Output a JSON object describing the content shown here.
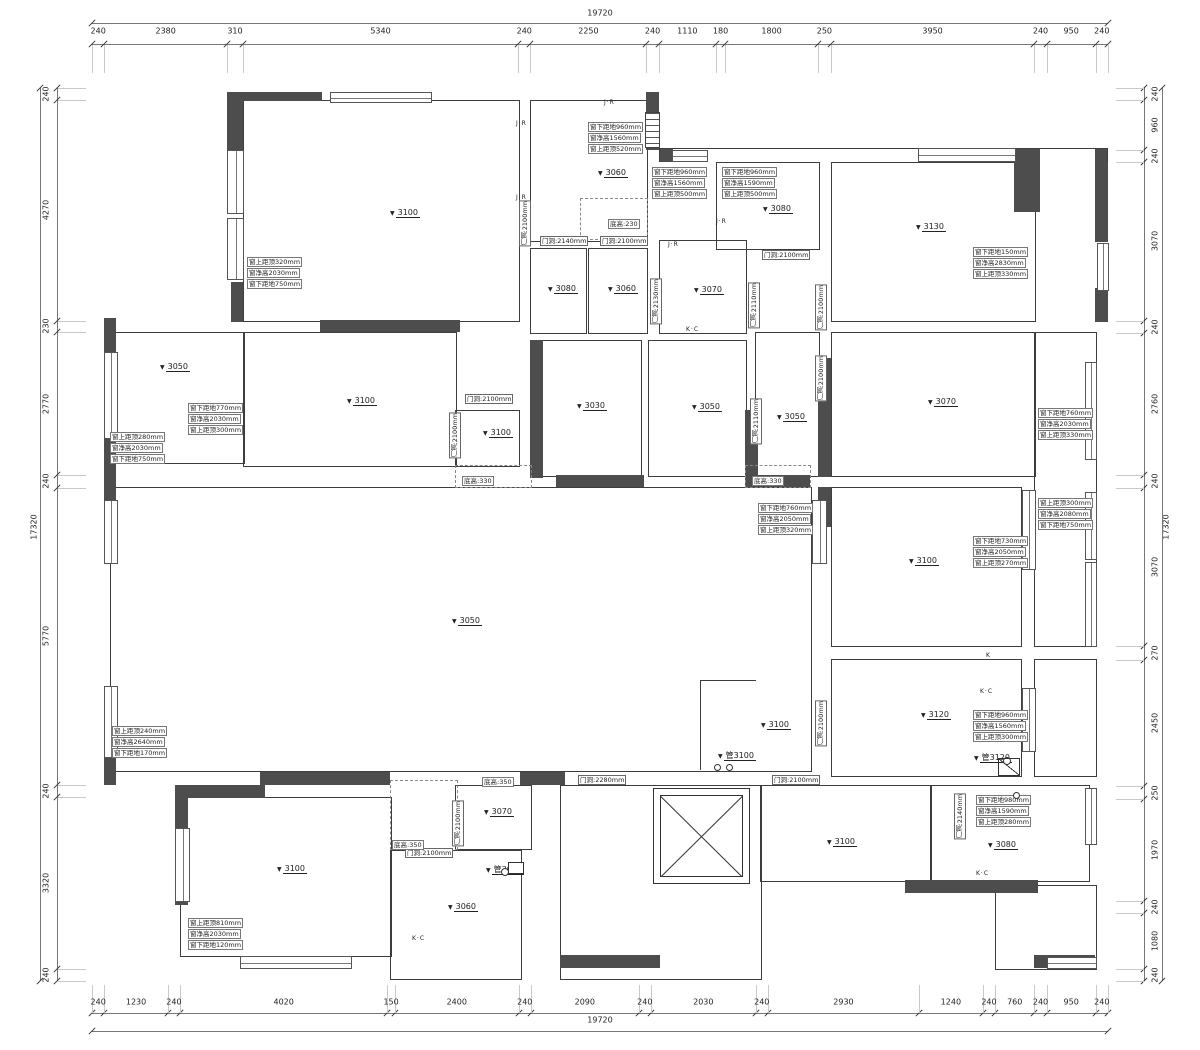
{
  "drawing_title": "floor-plan",
  "dims": {
    "top": {
      "total": "19720",
      "segments": [
        "240",
        "2380",
        "310",
        "5340",
        "240",
        "2250",
        "240",
        "1110",
        "180",
        "1800",
        "250",
        "3950",
        "240",
        "950",
        "240"
      ]
    },
    "bottom": {
      "total": "19720",
      "segments": [
        "240",
        "1230",
        "240",
        "4020",
        "150",
        "2400",
        "240",
        "2090",
        "240",
        "2030",
        "240",
        "2930",
        "1240",
        "240",
        "760",
        "240",
        "950",
        "240"
      ]
    },
    "left": {
      "total": "17320",
      "segments": [
        "240",
        "4270",
        "230",
        "2770",
        "240",
        "5770",
        "240",
        "3320",
        "240"
      ]
    },
    "right": {
      "total": "17320",
      "segments": [
        "240",
        "960",
        "240",
        "3070",
        "240",
        "2760",
        "240",
        "3070",
        "270",
        "2450",
        "250",
        "1970",
        "240",
        "1080",
        "240"
      ]
    }
  },
  "plan": {
    "wall_color": "#4d4d4d",
    "line_color": "#3d3d3d",
    "rooms": [
      [
        243,
        100,
        275,
        220
      ],
      [
        530,
        100,
        116,
        140
      ],
      [
        530,
        248,
        55,
        84
      ],
      [
        588,
        248,
        58,
        84
      ],
      [
        659,
        240,
        86,
        92
      ],
      [
        716,
        162,
        102,
        86
      ],
      [
        831,
        162,
        203,
        158
      ],
      [
        110,
        332,
        133,
        130
      ],
      [
        243,
        332,
        212,
        133
      ],
      [
        455,
        410,
        63,
        55
      ],
      [
        530,
        340,
        110,
        135
      ],
      [
        648,
        340,
        97,
        135
      ],
      [
        755,
        332,
        63,
        143
      ],
      [
        831,
        332,
        203,
        143
      ],
      [
        1034,
        332,
        61,
        313
      ],
      [
        110,
        487,
        700,
        283
      ],
      [
        831,
        487,
        189,
        158
      ],
      [
        831,
        659,
        189,
        116
      ],
      [
        1034,
        659,
        61,
        116
      ],
      [
        180,
        797,
        210,
        158
      ],
      [
        390,
        850,
        130,
        128
      ],
      [
        455,
        785,
        75,
        63
      ],
      [
        560,
        785,
        200,
        193
      ],
      [
        760,
        785,
        170,
        95
      ],
      [
        930,
        785,
        158,
        95
      ],
      [
        995,
        885,
        100,
        83
      ]
    ],
    "walls": [
      [
        232,
        92,
        90,
        9
      ],
      [
        227,
        92,
        16,
        66
      ],
      [
        231,
        282,
        12,
        40
      ],
      [
        320,
        320,
        140,
        12
      ],
      [
        104,
        318,
        12,
        160
      ],
      [
        646,
        92,
        13,
        58
      ],
      [
        659,
        148,
        14,
        14
      ],
      [
        1014,
        148,
        26,
        64
      ],
      [
        1095,
        148,
        13,
        94
      ],
      [
        1095,
        288,
        13,
        34
      ],
      [
        530,
        340,
        13,
        138
      ],
      [
        556,
        475,
        88,
        12
      ],
      [
        745,
        410,
        13,
        77
      ],
      [
        758,
        475,
        52,
        12
      ],
      [
        818,
        358,
        13,
        119
      ],
      [
        104,
        475,
        12,
        30
      ],
      [
        104,
        752,
        12,
        33
      ],
      [
        175,
        785,
        90,
        13
      ],
      [
        175,
        797,
        13,
        108
      ],
      [
        260,
        772,
        130,
        13
      ],
      [
        520,
        772,
        45,
        13
      ],
      [
        905,
        880,
        133,
        13
      ],
      [
        1034,
        955,
        61,
        13
      ],
      [
        560,
        955,
        100,
        13
      ],
      [
        818,
        487,
        13,
        40
      ]
    ],
    "lines": [
      [
        700,
        680,
        56,
        1
      ],
      [
        700,
        680,
        1,
        90
      ],
      [
        659,
        148,
        449,
        1
      ],
      [
        659,
        148,
        1,
        14
      ],
      [
        1107,
        148,
        1,
        14
      ]
    ],
    "windows": [
      [
        330,
        92,
        100,
        9,
        "h"
      ],
      [
        227,
        150,
        15,
        62,
        "v"
      ],
      [
        227,
        218,
        15,
        60,
        "v"
      ],
      [
        672,
        150,
        34,
        10,
        "h"
      ],
      [
        918,
        148,
        96,
        12,
        "h"
      ],
      [
        1097,
        243,
        10,
        46,
        "v"
      ],
      [
        104,
        352,
        12,
        85,
        "v"
      ],
      [
        104,
        500,
        12,
        62,
        "v"
      ],
      [
        104,
        686,
        12,
        70,
        "v"
      ],
      [
        1085,
        362,
        10,
        96,
        "v"
      ],
      [
        1022,
        490,
        12,
        78,
        "v"
      ],
      [
        1085,
        492,
        10,
        66,
        "v"
      ],
      [
        1085,
        562,
        10,
        83,
        "v"
      ],
      [
        812,
        500,
        13,
        62,
        "v"
      ],
      [
        1022,
        688,
        12,
        62,
        "v"
      ],
      [
        175,
        828,
        13,
        72,
        "v"
      ],
      [
        240,
        956,
        110,
        11,
        "h"
      ],
      [
        1047,
        957,
        48,
        10,
        "h"
      ],
      [
        1085,
        788,
        10,
        55,
        "v"
      ]
    ],
    "dashes": [
      [
        455,
        465,
        75,
        21
      ],
      [
        745,
        465,
        64,
        21
      ],
      [
        580,
        198,
        66,
        40
      ],
      [
        390,
        780,
        66,
        68
      ]
    ],
    "elevator": {
      "x": 653,
      "y": 788,
      "w": 95,
      "h": 94
    },
    "elevations": [
      {
        "label": "3100",
        "x": 390,
        "y": 209
      },
      {
        "label": "3060",
        "x": 598,
        "y": 169
      },
      {
        "label": "3080",
        "x": 548,
        "y": 285
      },
      {
        "label": "3060",
        "x": 608,
        "y": 285
      },
      {
        "label": "3070",
        "x": 694,
        "y": 286
      },
      {
        "label": "3080",
        "x": 763,
        "y": 205
      },
      {
        "label": "3130",
        "x": 916,
        "y": 223
      },
      {
        "label": "3050",
        "x": 160,
        "y": 363
      },
      {
        "label": "3100",
        "x": 347,
        "y": 397
      },
      {
        "label": "3100",
        "x": 483,
        "y": 429
      },
      {
        "label": "3030",
        "x": 577,
        "y": 402
      },
      {
        "label": "3050",
        "x": 692,
        "y": 403
      },
      {
        "label": "3050",
        "x": 777,
        "y": 413
      },
      {
        "label": "3070",
        "x": 928,
        "y": 398
      },
      {
        "label": "3050",
        "x": 452,
        "y": 617
      },
      {
        "label": "3100",
        "x": 909,
        "y": 557
      },
      {
        "label": "3120",
        "x": 921,
        "y": 711
      },
      {
        "label": "3100",
        "x": 761,
        "y": 721
      },
      {
        "label": "管3100",
        "x": 718,
        "y": 752
      },
      {
        "label": "管3120",
        "x": 974,
        "y": 754
      },
      {
        "label": "3100",
        "x": 277,
        "y": 865
      },
      {
        "label": "3070",
        "x": 484,
        "y": 808
      },
      {
        "label": "管3060",
        "x": 486,
        "y": 866
      },
      {
        "label": "3060",
        "x": 448,
        "y": 903
      },
      {
        "label": "3100",
        "x": 827,
        "y": 838
      },
      {
        "label": "3080",
        "x": 988,
        "y": 841
      }
    ],
    "window_notes": [
      {
        "x": 588,
        "y": 122,
        "lines": [
          "窗下距地960mm",
          "窗净高1560mm",
          "窗上距顶520mm"
        ]
      },
      {
        "x": 652,
        "y": 167,
        "lines": [
          "窗下距地960mm",
          "窗净高1560mm",
          "窗上距顶500mm"
        ]
      },
      {
        "x": 722,
        "y": 167,
        "lines": [
          "窗下距地960mm",
          "窗净高1590mm",
          "窗上距顶500mm"
        ]
      },
      {
        "x": 973,
        "y": 247,
        "lines": [
          "窗下距地150mm",
          "窗净高2830mm",
          "窗上距顶330mm"
        ]
      },
      {
        "x": 247,
        "y": 257,
        "lines": [
          "窗上距顶320mm",
          "窗净高2030mm",
          "窗下距地750mm"
        ]
      },
      {
        "x": 188,
        "y": 403,
        "lines": [
          "窗下距地770mm",
          "窗净高2030mm",
          "窗上距顶300mm"
        ]
      },
      {
        "x": 110,
        "y": 432,
        "lines": [
          "窗上距顶280mm",
          "窗净高2030mm",
          "窗下距地750mm"
        ]
      },
      {
        "x": 1038,
        "y": 408,
        "lines": [
          "窗下距地760mm",
          "窗净高2030mm",
          "窗上距顶330mm"
        ]
      },
      {
        "x": 758,
        "y": 503,
        "lines": [
          "窗下距地760mm",
          "窗净高2050mm",
          "窗上距顶320mm"
        ]
      },
      {
        "x": 1038,
        "y": 498,
        "lines": [
          "窗上距顶300mm",
          "窗净高2080mm",
          "窗下距地750mm"
        ]
      },
      {
        "x": 973,
        "y": 536,
        "lines": [
          "窗下距地730mm",
          "窗净高2050mm",
          "窗上距顶270mm"
        ]
      },
      {
        "x": 112,
        "y": 726,
        "lines": [
          "窗上距顶240mm",
          "窗净高2640mm",
          "窗下距地170mm"
        ]
      },
      {
        "x": 973,
        "y": 710,
        "lines": [
          "窗下距地960mm",
          "窗净高1560mm",
          "窗上距顶300mm"
        ]
      },
      {
        "x": 188,
        "y": 918,
        "lines": [
          "窗上距顶810mm",
          "窗净高2030mm",
          "窗下距地120mm"
        ]
      },
      {
        "x": 976,
        "y": 795,
        "lines": [
          "窗下距地980mm",
          "窗净高1590mm",
          "窗上距顶280mm"
        ]
      }
    ],
    "door_notes": [
      {
        "text": "门洞:2140mm",
        "x": 540,
        "y": 236,
        "v": false
      },
      {
        "text": "门洞:2100mm",
        "x": 600,
        "y": 236,
        "v": false
      },
      {
        "text": "门洞:2100mm",
        "x": 762,
        "y": 250,
        "v": false
      },
      {
        "text": "门洞:2100mm",
        "x": 519,
        "y": 200,
        "v": true
      },
      {
        "text": "门洞:2130mm",
        "x": 650,
        "y": 278,
        "v": true
      },
      {
        "text": "门洞:2110mm",
        "x": 748,
        "y": 282,
        "v": true
      },
      {
        "text": "门洞:2100mm",
        "x": 815,
        "y": 284,
        "v": true
      },
      {
        "text": "门洞:2100mm",
        "x": 815,
        "y": 355,
        "v": true
      },
      {
        "text": "门洞:2100mm",
        "x": 465,
        "y": 394,
        "v": false
      },
      {
        "text": "门洞:2100mm",
        "x": 449,
        "y": 412,
        "v": true
      },
      {
        "text": "门洞:2110mm",
        "x": 750,
        "y": 398,
        "v": true
      },
      {
        "text": "门洞:2100mm",
        "x": 815,
        "y": 700,
        "v": true
      },
      {
        "text": "门洞:2280mm",
        "x": 578,
        "y": 775,
        "v": false
      },
      {
        "text": "门洞:2100mm",
        "x": 772,
        "y": 775,
        "v": false
      },
      {
        "text": "门洞:2100mm",
        "x": 405,
        "y": 848,
        "v": false
      },
      {
        "text": "门洞:2100mm",
        "x": 452,
        "y": 800,
        "v": true
      },
      {
        "text": "门洞:2140mm",
        "x": 954,
        "y": 793,
        "v": true
      }
    ],
    "floor_notes": [
      {
        "text": "底高:230",
        "x": 608,
        "y": 219
      },
      {
        "text": "底高:330",
        "x": 462,
        "y": 476
      },
      {
        "text": "底高:330",
        "x": 752,
        "y": 476
      },
      {
        "text": "底高:350",
        "x": 482,
        "y": 777
      },
      {
        "text": "底高:350",
        "x": 392,
        "y": 840
      }
    ],
    "marks": [
      {
        "text": "J·R",
        "x": 604,
        "y": 99
      },
      {
        "text": "J·R",
        "x": 716,
        "y": 218
      },
      {
        "text": "J·R",
        "x": 668,
        "y": 241
      },
      {
        "text": "K·C",
        "x": 686,
        "y": 326
      },
      {
        "text": "J·R",
        "x": 516,
        "y": 120
      },
      {
        "text": "J·R",
        "x": 516,
        "y": 194
      },
      {
        "text": "K·C",
        "x": 412,
        "y": 935
      },
      {
        "text": "K·C",
        "x": 976,
        "y": 870
      },
      {
        "text": "K·C",
        "x": 980,
        "y": 688
      },
      {
        "text": "K",
        "x": 986,
        "y": 652
      }
    ],
    "circles": [
      [
        714,
        764,
        5
      ],
      [
        726,
        764,
        5
      ],
      [
        1003,
        757,
        6
      ],
      [
        501,
        868,
        6
      ],
      [
        1013,
        792,
        5
      ]
    ],
    "fixtures": {
      "hatch": [
        [
          645,
          112,
          13,
          34
        ]
      ],
      "corner": [
        [
          998,
          758,
          20,
          16
        ]
      ],
      "srect": [
        [
          508,
          862,
          14,
          10
        ]
      ]
    }
  }
}
